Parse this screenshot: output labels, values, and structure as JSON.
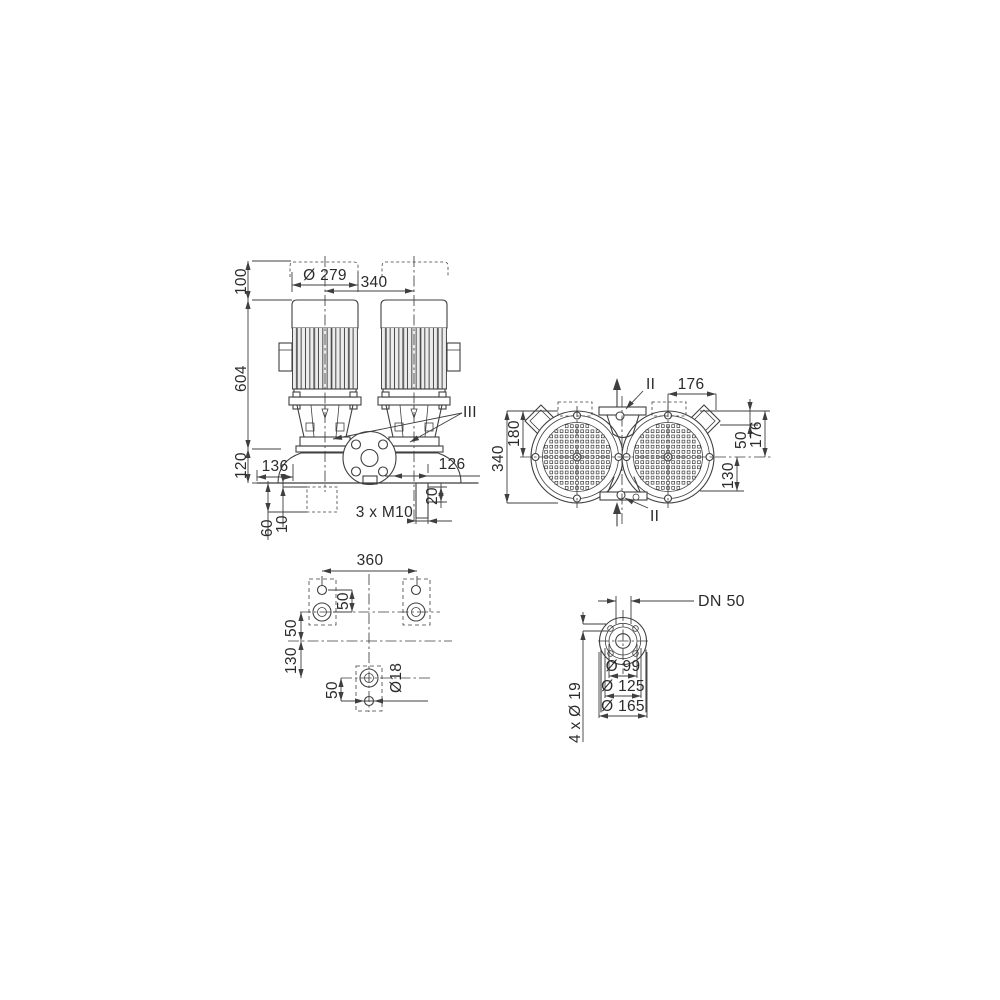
{
  "meta": {
    "background": "#ffffff",
    "line_color": "#3f3f3f",
    "text_color": "#2b2b2b",
    "drawing_type": "twin inline pump dimensional drawing"
  },
  "views": {
    "front": {
      "name": "front-elevation",
      "dims": {
        "clearance": "100",
        "height": "604",
        "base": "120",
        "motor_dia": "Ø 279",
        "spacing": "340",
        "left_port": "136",
        "right_port": "126",
        "foot_slot": "20",
        "foot_thread": "3 x M10",
        "found_depth": "60",
        "found_gap": "10",
        "section": "III"
      }
    },
    "plan": {
      "name": "top-view",
      "dims": {
        "width": "340",
        "half_width": "180",
        "port_pitch": "176",
        "box_offset": "50",
        "depth": "176",
        "lower": "130",
        "section_top": "II",
        "section_bottom": "II"
      }
    },
    "base": {
      "name": "foundation-plan",
      "dims": {
        "length": "360",
        "hole_gap": "50",
        "row_offset": "50",
        "row_spacing": "130",
        "foot_gap": "50",
        "hole_dia": "Ø18"
      }
    },
    "flange": {
      "name": "flange-detail",
      "dims": {
        "nominal": "DN 50",
        "face": "Ø 99",
        "bolt_circle": "Ø 125",
        "outer": "Ø 165",
        "holes": "4 x Ø 19"
      }
    }
  }
}
